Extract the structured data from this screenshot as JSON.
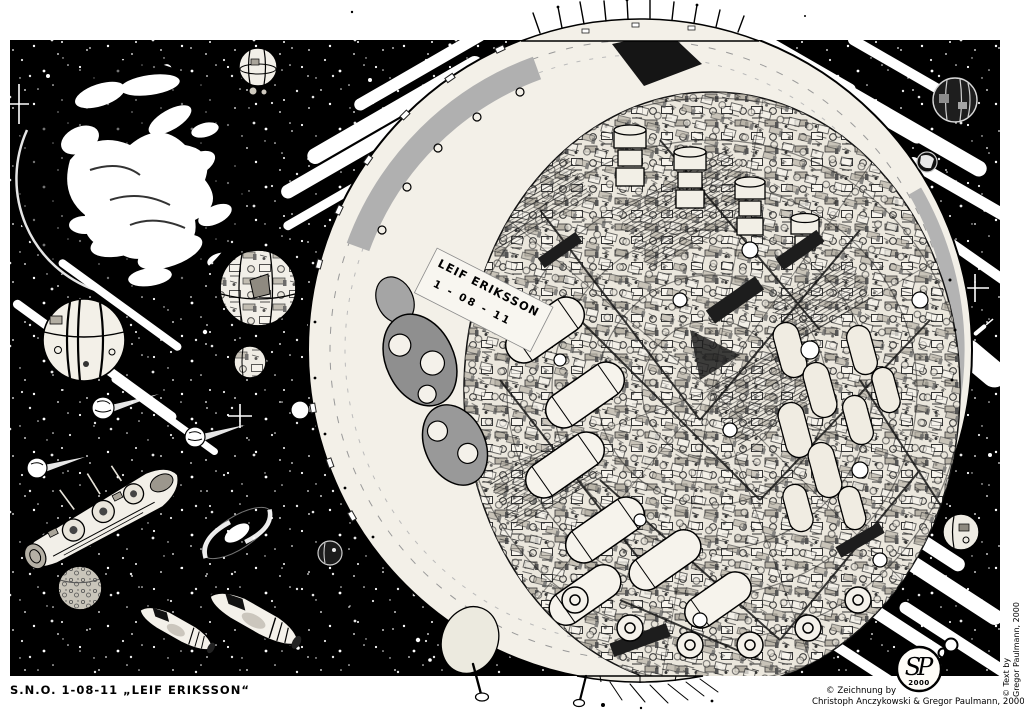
{
  "artwork": {
    "title_caption": "S.N.O. 1-08-11 „LEIF ERIKSSON“",
    "ship": {
      "name_label": "LEIF ERIKSSON",
      "registry_label": "1 - 08 - 11"
    },
    "credits": {
      "drawing_prefix": "© Zeichnung by",
      "drawing_names": "Christoph Anczykowski & Gregor Paulmann, 2000",
      "text_prefix": "© Text by",
      "text_names": "Gregor Paulmann, 2000"
    },
    "badge": {
      "monogram": "SP",
      "year": "2000"
    },
    "colors": {
      "ink": "#000000",
      "paper": "#ffffff",
      "hull_gray": "#aaaaaa"
    }
  }
}
